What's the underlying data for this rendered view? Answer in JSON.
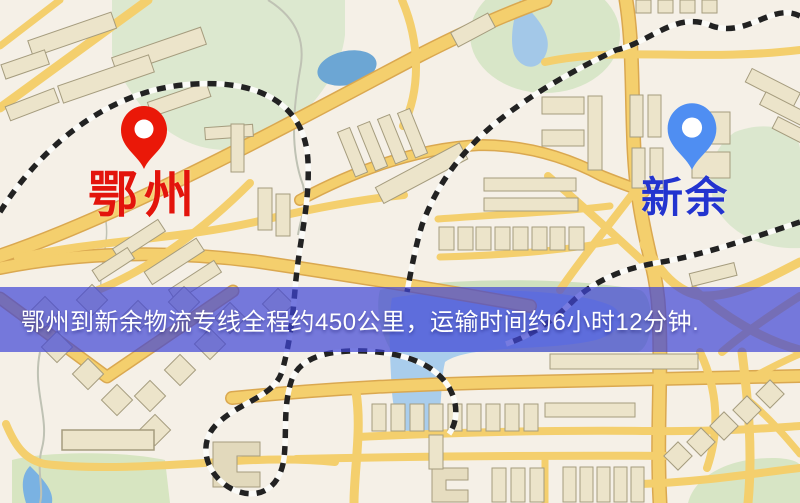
{
  "map": {
    "origin": {
      "label": "鄂州",
      "pin_color": "#ea1808",
      "label_color": "#e3140c"
    },
    "destination": {
      "label": "新余",
      "pin_color": "#4f8ef2",
      "label_color": "#2334cf"
    },
    "banner": {
      "text": "鄂州到新余物流专线全程约450公里，运输时间约6小时12分钟.",
      "background": "rgba(62,68,214,0.70)",
      "text_color": "#ffffff",
      "route": {
        "from": "鄂州",
        "to": "新余",
        "distance": "约450公里",
        "duration": "约6小时12分钟"
      }
    },
    "palette": {
      "map_background": "#f5f0e7",
      "road": "#f4cf6d",
      "road_casing": "#daa850",
      "park": "#dce8cf",
      "water": "#a9cdec",
      "building": "#ece4ca",
      "railway": "#222222"
    }
  }
}
